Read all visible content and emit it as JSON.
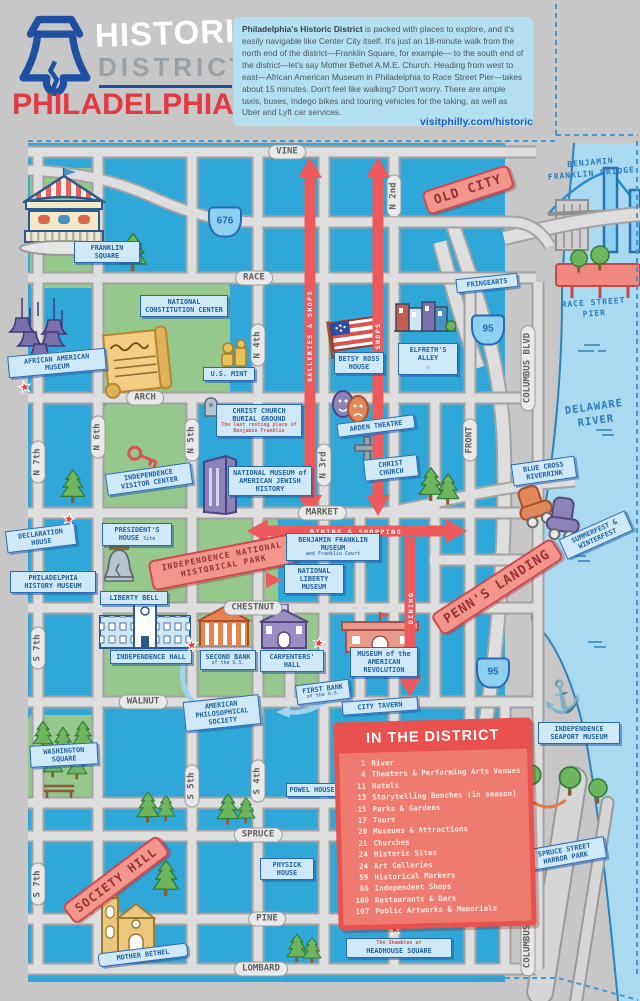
{
  "header": {
    "logo": {
      "line1": "HISTORIC",
      "line2": "DISTRICT",
      "line3": "PHILADELPHIA"
    },
    "intro_bold": "Philadelphia's Historic District",
    "intro_text": " is packed with places to explore, and it's easily navigable like Center City itself. It's just an 18-minute walk from the north end of the district—Franklin Square, for example— to the south end of the district—let's say Mother Bethel A.M.E. Church. Heading from west to east—African American Museum in Philadelphia to Race Street Pier—takes about 15 minutes. Don't feel like walking? Don't worry. There are ample taxis, buses, Indego bikes and touring vehicles for the taking, as well as Uber and Lyft car services.",
    "url": "visitphilly.com/historic"
  },
  "colors": {
    "map_blue": "#2fa8d9",
    "river_blue": "#a9daf0",
    "park_green": "#96c78c",
    "accent_red": "#ee5a5c",
    "sign_blue": "#2a68b2",
    "brand_blue": "#1f4fa0",
    "brand_red": "#e13a43"
  },
  "map": {
    "streets": {
      "vine": "VINE",
      "race": "RACE",
      "arch": "ARCH",
      "market": "MARKET",
      "chestnut": "CHESTNUT",
      "walnut": "WALNUT",
      "spruce": "SPRUCE",
      "pine": "PINE",
      "lombard": "LOMBARD",
      "n7": "N 7th",
      "n6": "N 6th",
      "n5": "N 5th",
      "n4": "N 4th",
      "n3": "N 3rd",
      "n2": "N 2nd",
      "s7": "S 7th",
      "s5": "S 5th",
      "s4": "S 4th",
      "front": "FRONT",
      "columbus": "COLUMBUS BLVD"
    },
    "highways": {
      "i676": "676",
      "i95": "95"
    },
    "districts": {
      "old_city": "OLD CITY",
      "inhp": "INDEPENDENCE NATIONAL HISTORICAL PARK",
      "penns_landing": "PENN'S LANDING",
      "society_hill": "SOCIETY HILL"
    },
    "arrows": {
      "galleries": "GALLERIES & SHOPS",
      "shops": "SHOPS",
      "dining_shopping": "DINING & SHOPPING",
      "dining": "DINING"
    },
    "landmarks": {
      "franklin_square": "FRANKLIN SQUARE",
      "constitution": "NATIONAL CONSTITUTION CENTER",
      "aam": "AFRICAN AMERICAN MUSEUM",
      "us_mint": "U.S. MINT",
      "betsy_ross": "BETSY ROSS HOUSE",
      "elfreths": "ELFRETH'S ALLEY",
      "fringearts": "FRINGEARTS",
      "burial_ground": "CHRIST CHURCH BURIAL GROUND",
      "burial_ground_sub": "The last resting place of Benjamin Franklin",
      "visitor_center": "INDEPENDENCE VISITOR CENTER",
      "nmajh": "NATIONAL MUSEUM of AMERICAN JEWISH HISTORY",
      "arden": "ARDEN THEATRE",
      "christ_church": "CHRIST CHURCH",
      "declaration": "DECLARATION HOUSE",
      "presidents_house": "PRESIDENT'S HOUSE",
      "presidents_house_sub": "Site",
      "phm": "PHILADELPHIA HISTORY MUSEUM",
      "liberty_bell": "LIBERTY BELL",
      "bf_museum": "BENJAMIN FRANKLIN MUSEUM",
      "bf_museum_sub": "and Franklin Court",
      "nlm": "NATIONAL LIBERTY MUSEUM",
      "independence_hall": "INDEPENDENCE HALL",
      "second_bank": "SECOND BANK",
      "second_bank_sub": "of the U.S.",
      "carpenters": "CARPENTERS' HALL",
      "moar": "MUSEUM of the AMERICAN REVOLUTION",
      "first_bank": "FIRST BANK",
      "first_bank_sub": "of the U.S.",
      "aps": "AMERICAN PHILOSOPHICAL SOCIETY",
      "city_tavern": "CITY TAVERN",
      "washington_sq": "WASHINGTON SQUARE",
      "powel": "POWEL HOUSE",
      "physick": "PHYSICK HOUSE",
      "mother_bethel": "MOTHER BETHEL",
      "headhouse": "HEADHOUSE SQUARE",
      "headhouse_sub": "The Shambles at",
      "seaport": "INDEPENDENCE SEAPORT MUSEUM",
      "riverrink": "BLUE CROSS RIVERRINK",
      "summerfest": "SUMMERFEST & WINTERFEST",
      "harbor_park": "SPRUCE STREET HARBOR PARK",
      "bridge": "BENJAMIN FRANKLIN BRIDGE",
      "race_pier": "RACE STREET PIER",
      "delaware": "DELAWARE RIVER"
    }
  },
  "legend": {
    "title": "IN THE DISTRICT",
    "items": [
      {
        "num": "1",
        "label": "River"
      },
      {
        "num": "4",
        "label": "Theaters & Performing Arts Venues"
      },
      {
        "num": "11",
        "label": "Hotels"
      },
      {
        "num": "13",
        "label": "Storytelling Benches (in season)"
      },
      {
        "num": "15",
        "label": "Parks & Gardens"
      },
      {
        "num": "17",
        "label": "Tours"
      },
      {
        "num": "20",
        "label": "Museums & Attractions"
      },
      {
        "num": "21",
        "label": "Churches"
      },
      {
        "num": "24",
        "label": "Historic Sites"
      },
      {
        "num": "24",
        "label": "Art Galleries"
      },
      {
        "num": "59",
        "label": "Historical Markers"
      },
      {
        "num": "86",
        "label": "Independent Shops"
      },
      {
        "num": "100",
        "label": "Restaurants & Bars"
      },
      {
        "num": "107",
        "label": "Public Artworks & Memorials"
      }
    ]
  }
}
